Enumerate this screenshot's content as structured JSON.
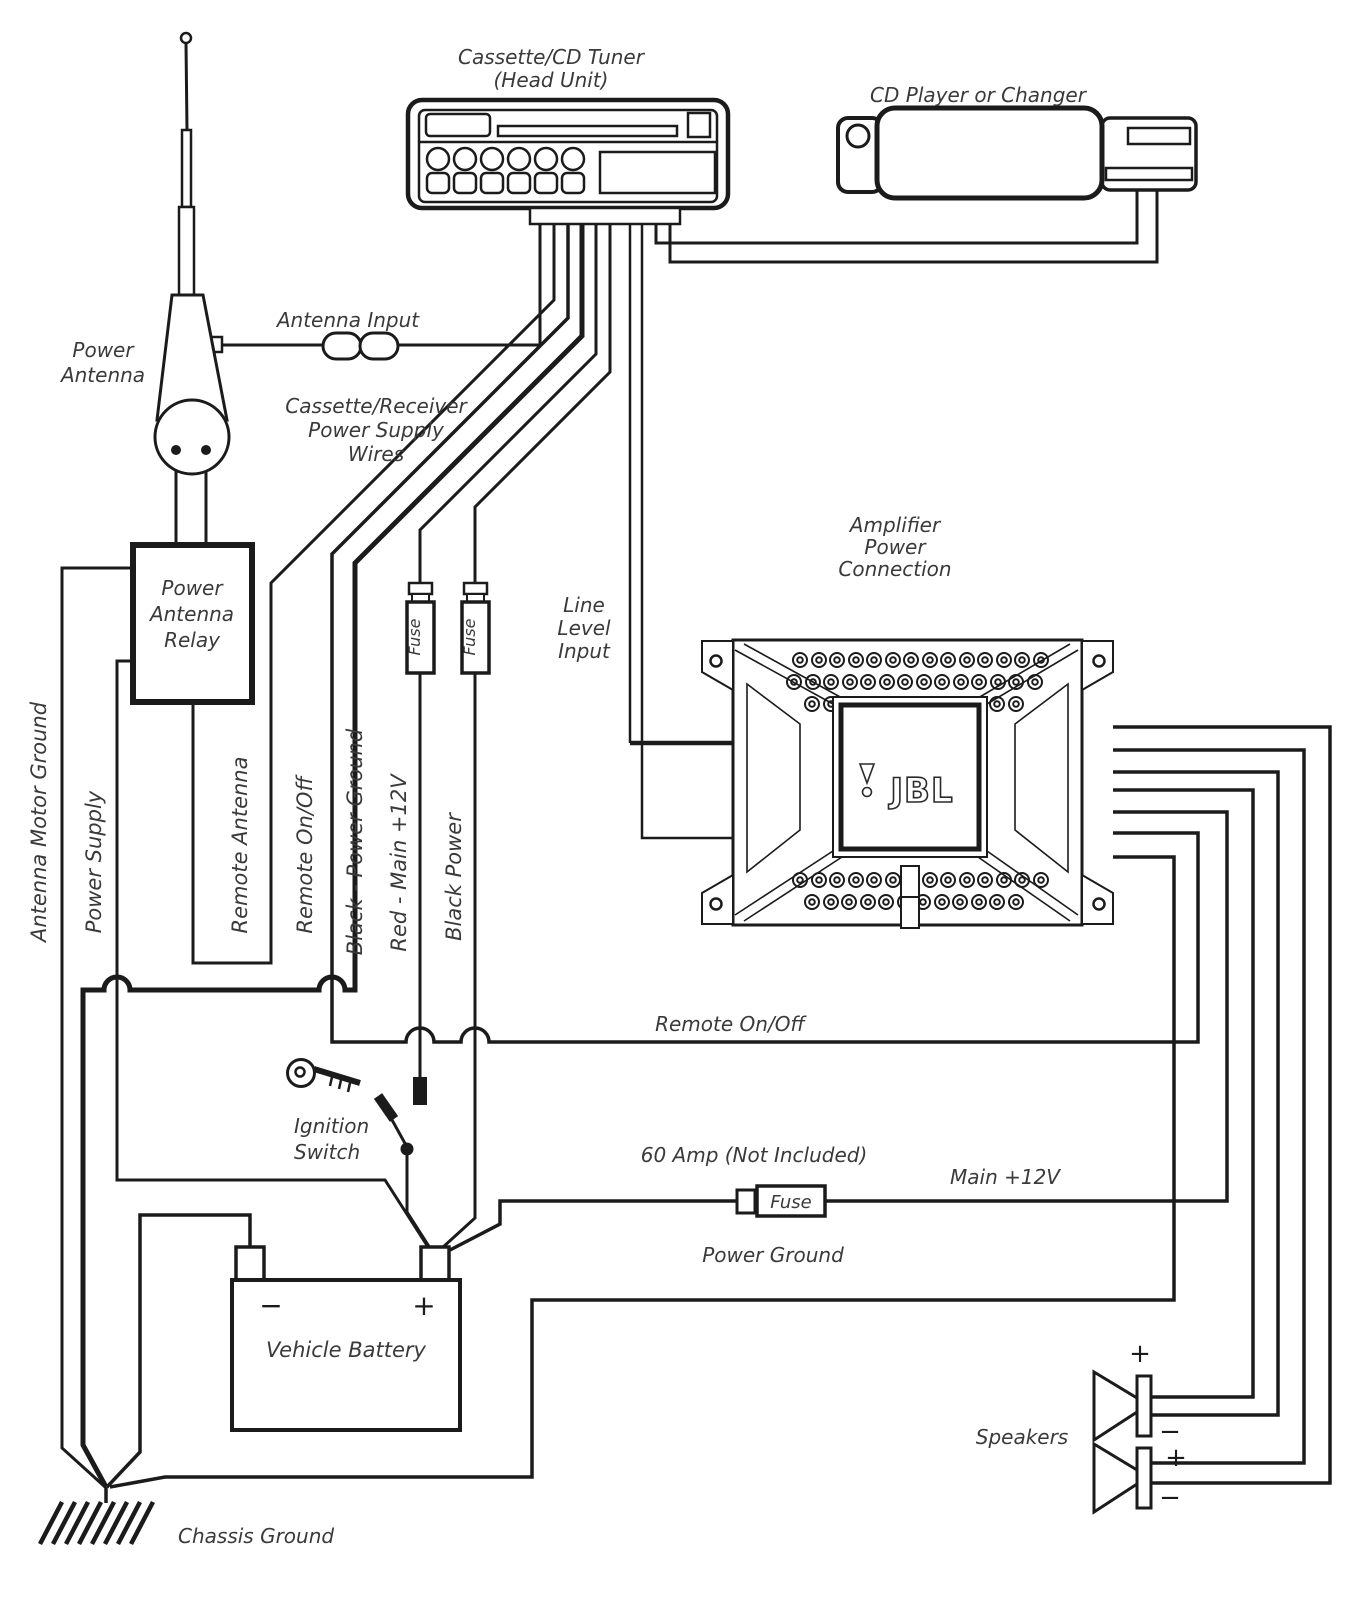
{
  "diagram_title": "Car Audio Amplifier Wiring Diagram",
  "colors": {
    "line": "#1b1b1b",
    "text": "#3a3a3a",
    "background": "#ffffff"
  },
  "labels": {
    "tuner1": "Cassette/CD Tuner",
    "tuner2": "(Head Unit)",
    "cd_changer": "CD Player or Changer",
    "antenna_input": "Antenna Input",
    "power_antenna1": "Power",
    "power_antenna2": "Antenna",
    "cas1": "Cassette/Receiver",
    "cas2": "Power Supply",
    "cas3": "Wires",
    "relay1": "Power",
    "relay2": "Antenna",
    "relay3": "Relay",
    "amp1": "Amplifier",
    "amp2": "Power",
    "amp3": "Connection",
    "jbl": "JBL",
    "line1": "Line",
    "line2": "Level",
    "line3": "Input",
    "v_antenna_motor_ground": "Antenna Motor Ground",
    "v_power_supply": "Power Supply",
    "v_remote_antenna": "Remote Antenna",
    "v_remote_on_off": "Remote On/Off",
    "v_black_power_ground": "Black - Power Ground",
    "v_red_main_12v": "Red - Main +12V",
    "v_black_power": "Black Power",
    "fuse": "Fuse",
    "remote_on_off_run": "Remote On/Off",
    "sixty_amp": "60 Amp (Not Included)",
    "main_12v": "Main +12V",
    "power_ground": "Power Ground",
    "ignition1": "Ignition",
    "ignition2": "Switch",
    "battery": "Vehicle Battery",
    "battery_minus": "−",
    "battery_plus": "+",
    "speakers": "Speakers",
    "spk_top_plus": "+",
    "spk_top_minus": "−",
    "spk_bottom_plus": "+",
    "spk_bottom_minus": "−",
    "chassis_ground": "Chassis Ground"
  }
}
